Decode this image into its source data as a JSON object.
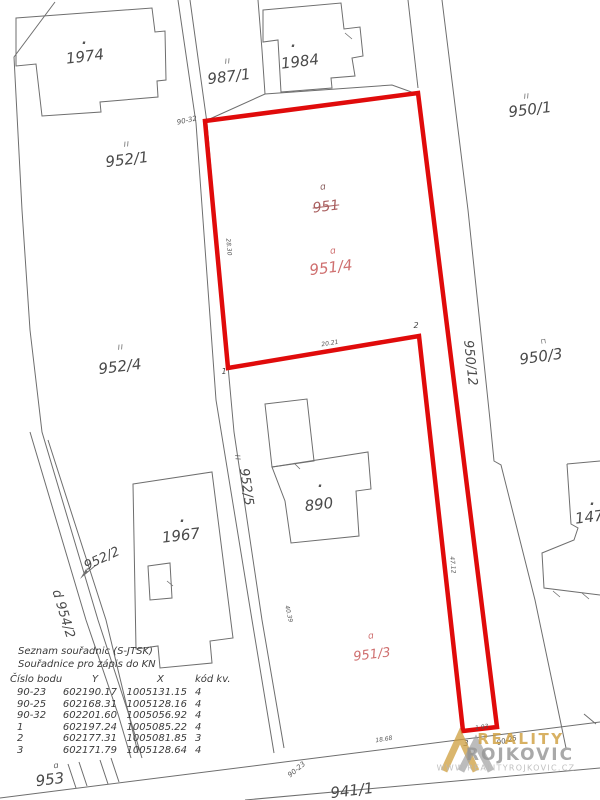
{
  "map": {
    "line_color": "#6e6e6e",
    "highlight_color": "#e00b0b",
    "labels": [
      {
        "n": "parcel-1974",
        "t": "1974",
        "x": 85,
        "y": 57,
        "r": -7,
        "c": "parcel"
      },
      {
        "n": "parcel-987-1",
        "t": "987/1",
        "x": 229,
        "y": 77,
        "r": -7,
        "c": "parcel"
      },
      {
        "n": "parcel-1984",
        "t": "1984",
        "x": 300,
        "y": 62,
        "r": -7,
        "c": "parcel"
      },
      {
        "n": "parcel-950-1",
        "t": "950/1",
        "x": 530,
        "y": 110,
        "r": -7,
        "c": "parcel"
      },
      {
        "n": "parcel-952-1",
        "t": "952/1",
        "x": 127,
        "y": 160,
        "r": -7,
        "c": "parcel"
      },
      {
        "n": "parcel-952-4",
        "t": "952/4",
        "x": 120,
        "y": 367,
        "r": -7,
        "c": "parcel"
      },
      {
        "n": "parcel-950-3",
        "t": "950/3",
        "x": 541,
        "y": 357,
        "r": -8,
        "c": "parcel"
      },
      {
        "n": "parcel-950-12",
        "t": "950/12",
        "x": 470,
        "y": 363,
        "r": 84,
        "c": "parcel-md"
      },
      {
        "n": "parcel-952-5",
        "t": "952/5",
        "x": 246,
        "y": 487,
        "r": 82,
        "c": "parcel-md"
      },
      {
        "n": "building-890",
        "t": "890",
        "x": 319,
        "y": 505,
        "r": -7,
        "c": "parcel"
      },
      {
        "n": "building-1967",
        "t": "1967",
        "x": 181,
        "y": 536,
        "r": -7,
        "c": "parcel"
      },
      {
        "n": "building-1473",
        "t": "1473",
        "x": 594,
        "y": 517,
        "r": -7,
        "c": "parcel"
      },
      {
        "n": "parcel-952-2",
        "t": "952/2",
        "x": 102,
        "y": 559,
        "r": -25,
        "c": "parcel-md"
      },
      {
        "n": "parcel-954-2",
        "t": "d 954/2",
        "x": 63,
        "y": 614,
        "r": 73,
        "c": "parcel-md"
      },
      {
        "n": "parcel-953",
        "t": "953",
        "x": 50,
        "y": 780,
        "r": -7,
        "c": "parcel"
      },
      {
        "n": "parcel-941-1",
        "t": "941/1",
        "x": 352,
        "y": 791,
        "r": -7,
        "c": "parcel"
      },
      {
        "n": "parcel-951-cancelled",
        "t": "951",
        "x": 326,
        "y": 207,
        "r": -7,
        "c": "strike"
      },
      {
        "n": "parcel-951-4",
        "t": "951/4",
        "x": 331,
        "y": 268,
        "r": -7,
        "c": "red"
      },
      {
        "n": "parcel-951-3",
        "t": "951/3",
        "x": 372,
        "y": 655,
        "r": -7,
        "c": "red-md"
      },
      {
        "n": "landuse-symbol-951",
        "t": "ɑ",
        "x": 323,
        "y": 188,
        "r": -7,
        "c": "symd"
      },
      {
        "n": "landuse-symbol-951-4",
        "t": "ɑ",
        "x": 333,
        "y": 252,
        "r": -7,
        "c": "symr"
      },
      {
        "n": "landuse-symbol-951-3",
        "t": "ɑ",
        "x": 371,
        "y": 637,
        "r": -7,
        "c": "symr"
      },
      {
        "n": "landuse-symbol-953",
        "t": "ɑ",
        "x": 56,
        "y": 766,
        "r": -7,
        "c": "symg"
      },
      {
        "n": "boundary-marker-987-1",
        "t": "II",
        "x": 228,
        "y": 62,
        "r": -7,
        "c": "marker"
      },
      {
        "n": "boundary-marker-952-1",
        "t": "II",
        "x": 127,
        "y": 145,
        "r": -7,
        "c": "marker"
      },
      {
        "n": "boundary-marker-950-1",
        "t": "II",
        "x": 527,
        "y": 97,
        "r": -7,
        "c": "marker"
      },
      {
        "n": "boundary-marker-952-4",
        "t": "II",
        "x": 121,
        "y": 348,
        "r": -7,
        "c": "marker"
      },
      {
        "n": "boundary-marker-952-5",
        "t": "II",
        "x": 237,
        "y": 458,
        "r": 82,
        "c": "marker"
      },
      {
        "n": "landuse-marker-950-3",
        "t": "⊓",
        "x": 544,
        "y": 342,
        "r": -8,
        "c": "marker"
      },
      {
        "n": "point-label-90-32",
        "t": "90-32",
        "x": 187,
        "y": 121,
        "r": -12,
        "c": "tiny"
      },
      {
        "n": "point-label-90-23",
        "t": "90-23",
        "x": 297,
        "y": 770,
        "r": -40,
        "c": "tiny"
      },
      {
        "n": "point-label-90-25",
        "t": "90-25",
        "x": 507,
        "y": 741,
        "r": -15,
        "c": "tiny"
      },
      {
        "n": "point-label-1",
        "t": "1",
        "x": 224,
        "y": 372,
        "r": 0,
        "c": "pt"
      },
      {
        "n": "point-label-2",
        "t": "2",
        "x": 416,
        "y": 326,
        "r": 0,
        "c": "pt"
      },
      {
        "n": "point-label-3",
        "t": "3",
        "x": 466,
        "y": 744,
        "r": 0,
        "c": "pt"
      },
      {
        "n": "measure-18-68",
        "t": "18.68",
        "x": 384,
        "y": 740,
        "r": -9,
        "c": "micro"
      },
      {
        "n": "measure-1-93",
        "t": "1.93",
        "x": 482,
        "y": 728,
        "r": -9,
        "c": "micro"
      },
      {
        "n": "measure-28-30",
        "t": "28.30",
        "x": 228,
        "y": 247,
        "r": 85,
        "c": "micro"
      },
      {
        "n": "measure-20-21",
        "t": "20.21",
        "x": 330,
        "y": 344,
        "r": -9,
        "c": "micro"
      },
      {
        "n": "measure-47-12",
        "t": "47.12",
        "x": 452,
        "y": 565,
        "r": 85,
        "c": "micro"
      },
      {
        "n": "measure-40-39",
        "t": "40.39",
        "x": 288,
        "y": 614,
        "r": 77,
        "c": "micro"
      },
      {
        "n": "building-dot-1974",
        "t": "·",
        "x": 84,
        "y": 44,
        "r": 0,
        "c": "dot"
      },
      {
        "n": "building-dot-1984",
        "t": "·",
        "x": 293,
        "y": 47,
        "r": 0,
        "c": "dot"
      },
      {
        "n": "building-dot-890",
        "t": "·",
        "x": 320,
        "y": 487,
        "r": 0,
        "c": "dot"
      },
      {
        "n": "building-dot-1967",
        "t": "·",
        "x": 182,
        "y": 522,
        "r": 0,
        "c": "dot"
      },
      {
        "n": "building-dot-1473",
        "t": "·",
        "x": 592,
        "y": 505,
        "r": 0,
        "c": "dot"
      }
    ]
  },
  "coord_table": {
    "title": "Seznam souřadnic (S-JTSK)",
    "subtitle": "Souřadnice pro zápis do KN",
    "headers": {
      "id": "Číslo bodu",
      "y": "Y",
      "x": "X",
      "code": "kód kv."
    },
    "rows": [
      {
        "id": "90-23",
        "y": "602190.17",
        "x": "1005131.15",
        "code": "4"
      },
      {
        "id": "90-25",
        "y": "602168.31",
        "x": "1005128.16",
        "code": "4"
      },
      {
        "id": "90-32",
        "y": "602201.60",
        "x": "1005056.92",
        "code": "4"
      },
      {
        "id": "1",
        "y": "602197.24",
        "x": "1005085.22",
        "code": "4"
      },
      {
        "id": "2",
        "y": "602177.31",
        "x": "1005081.85",
        "code": "3"
      },
      {
        "id": "3",
        "y": "602171.79",
        "x": "1005128.64",
        "code": "4"
      }
    ]
  },
  "watermark": {
    "brand_top": "REALITY",
    "brand_bottom": "ROJKOVIC",
    "url": "WWW.REALITYROJKOVIC.CZ",
    "gold": "#ce9d3c",
    "gray": "#a0a0a0"
  }
}
